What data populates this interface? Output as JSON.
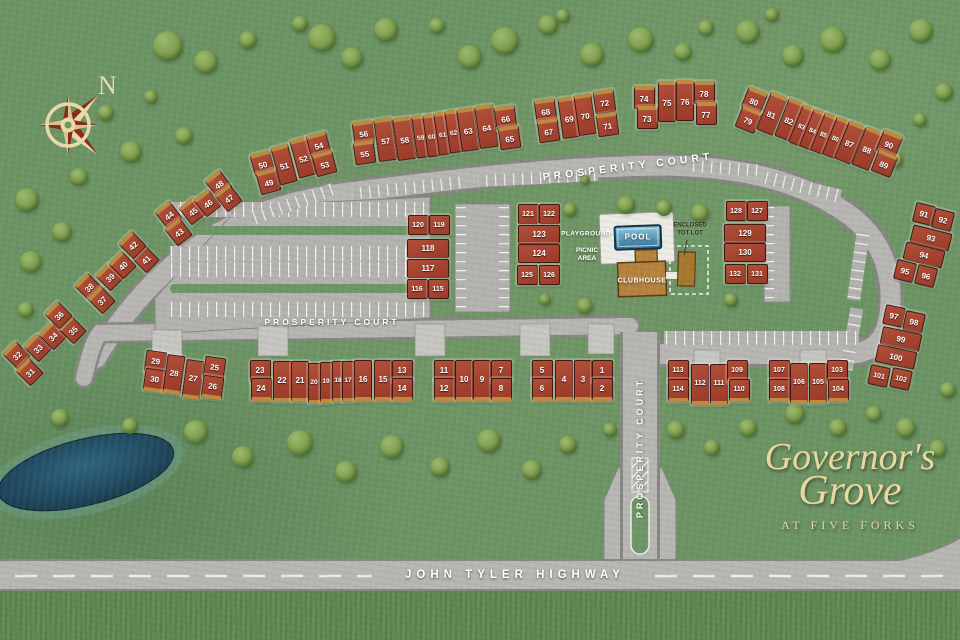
{
  "title": "Governor's Grove at Five Forks site plan",
  "compass": {
    "north": "N"
  },
  "streets": {
    "prosperity_top": "PROSPERITY COURT",
    "prosperity_mid": "PROSPERITY COURT",
    "prosperity_entrance": "PROSPERITY COURT",
    "highway": "JOHN TYLER HIGHWAY"
  },
  "amenities": {
    "playground": "PLAYGROUND",
    "picnic_line1": "PICNIC",
    "picnic_line2": "AREA",
    "pool": "POOL",
    "clubhouse": "CLUBHOUSE",
    "totlot_line1": "ENCLOSED",
    "totlot_line2": "TOT LOT"
  },
  "logo": {
    "line1": "Governor's",
    "line2": "Grove",
    "line3": "AT FIVE FORKS"
  },
  "colors": {
    "grass": "#6c9364",
    "road": "#b7b6b3",
    "building": "#a64733",
    "garage": "#bf8a3e",
    "pond": "#1d4a61",
    "pool_water": "#4a94b8",
    "clubhouse": "#b5813e",
    "logo_text": "#e9d6a0",
    "compass_cream": "#ead9a8",
    "compass_red": "#8c2b1b"
  },
  "buildings": {
    "clusters": [
      {
        "rot": 0,
        "garage": "bottom",
        "units": [
          [
            5,
            541,
            369,
            19,
            18
          ],
          [
            6,
            541,
            387,
            19,
            18
          ],
          [
            4,
            563,
            378,
            16,
            36
          ],
          [
            3,
            582,
            378,
            16,
            36
          ],
          [
            1,
            601,
            369,
            19,
            18
          ],
          [
            2,
            601,
            387,
            19,
            18
          ]
        ]
      },
      {
        "rot": 0,
        "garage": "bottom",
        "units": [
          [
            11,
            443,
            369,
            19,
            18
          ],
          [
            12,
            443,
            387,
            19,
            18
          ],
          [
            10,
            463,
            378,
            16,
            36
          ],
          [
            9,
            481,
            378,
            16,
            36
          ],
          [
            7,
            500,
            369,
            19,
            18
          ],
          [
            8,
            500,
            387,
            19,
            18
          ]
        ]
      },
      {
        "rot": 0,
        "garage": "bottom",
        "units": [
          [
            23,
            259,
            369,
            19,
            18
          ],
          [
            24,
            260,
            387,
            19,
            18
          ],
          [
            22,
            281,
            379,
            17,
            36
          ],
          [
            21,
            299,
            379,
            16,
            36
          ],
          [
            20,
            313,
            381,
            11,
            36
          ],
          [
            19,
            325,
            380,
            11,
            36
          ],
          [
            18,
            337,
            379,
            11,
            36
          ],
          [
            17,
            347,
            379,
            11,
            36
          ],
          [
            16,
            362,
            378,
            16,
            36
          ],
          [
            15,
            382,
            378,
            16,
            36
          ],
          [
            13,
            401,
            369,
            19,
            18
          ],
          [
            14,
            401,
            387,
            19,
            18
          ]
        ]
      },
      {
        "rot": 8,
        "garage": "bottom",
        "units": [
          [
            29,
            154,
            360,
            19,
            18
          ],
          [
            30,
            153,
            378,
            19,
            18
          ],
          [
            28,
            173,
            372,
            16,
            34
          ],
          [
            27,
            192,
            377,
            16,
            34
          ],
          [
            25,
            213,
            366,
            19,
            18
          ],
          [
            26,
            211,
            385,
            19,
            18
          ]
        ]
      },
      {
        "rot": 0,
        "garage": "bottom",
        "units": [
          [
            113,
            677,
            369,
            19,
            18
          ],
          [
            114,
            677,
            388,
            19,
            18
          ],
          [
            112,
            699,
            382,
            16,
            36
          ],
          [
            111,
            718,
            382,
            16,
            36
          ],
          [
            109,
            736,
            369,
            19,
            18
          ],
          [
            110,
            738,
            388,
            19,
            18
          ]
        ]
      },
      {
        "rot": 0,
        "garage": "bottom",
        "units": [
          [
            107,
            778,
            369,
            19,
            18
          ],
          [
            108,
            778,
            388,
            19,
            18
          ],
          [
            106,
            798,
            381,
            16,
            36
          ],
          [
            105,
            817,
            381,
            16,
            36
          ],
          [
            103,
            836,
            369,
            19,
            18
          ],
          [
            104,
            837,
            388,
            19,
            18
          ]
        ]
      },
      {
        "rot": -45,
        "garage": "top",
        "units": [
          [
            32,
            15,
            352,
            17,
            17
          ],
          [
            31,
            28,
            369,
            17,
            17
          ],
          [
            33,
            36,
            345,
            17,
            17
          ],
          [
            34,
            51,
            333,
            17,
            17
          ],
          [
            35,
            71,
            327,
            17,
            17
          ],
          [
            36,
            57,
            312,
            17,
            17
          ]
        ]
      },
      {
        "rot": -45,
        "garage": "top",
        "units": [
          [
            38,
            87,
            284,
            17,
            17
          ],
          [
            37,
            100,
            297,
            17,
            17
          ],
          [
            39,
            108,
            274,
            17,
            17
          ],
          [
            40,
            121,
            262,
            17,
            17
          ],
          [
            41,
            144,
            256,
            17,
            17
          ],
          [
            42,
            131,
            242,
            17,
            17
          ]
        ]
      },
      {
        "rot": -38,
        "garage": "top",
        "units": [
          [
            44,
            167,
            212,
            17,
            17
          ],
          [
            43,
            177,
            229,
            17,
            17
          ],
          [
            45,
            191,
            208,
            17,
            17
          ],
          [
            46,
            206,
            200,
            17,
            17
          ],
          [
            48,
            217,
            181,
            17,
            17
          ],
          [
            47,
            227,
            195,
            17,
            17
          ]
        ]
      },
      {
        "rot": -15,
        "garage": "top",
        "units": [
          [
            50,
            261,
            161,
            19,
            18
          ],
          [
            49,
            267,
            179,
            19,
            18
          ],
          [
            51,
            283,
            162,
            16,
            34
          ],
          [
            52,
            302,
            155,
            16,
            34
          ],
          [
            54,
            317,
            142,
            19,
            18
          ],
          [
            53,
            323,
            161,
            19,
            18
          ]
        ]
      },
      {
        "rot": -8,
        "garage": "top",
        "units": [
          [
            56,
            362,
            130,
            19,
            18
          ],
          [
            55,
            363,
            150,
            19,
            18
          ],
          [
            57,
            384,
            137,
            17,
            38
          ],
          [
            58,
            403,
            136,
            17,
            38
          ],
          [
            59,
            419,
            134,
            11,
            38
          ],
          [
            60,
            430,
            133,
            11,
            38
          ],
          [
            61,
            441,
            131,
            11,
            38
          ],
          [
            62,
            452,
            129,
            11,
            38
          ],
          [
            63,
            467,
            127,
            16,
            38
          ],
          [
            64,
            485,
            124,
            17,
            38
          ],
          [
            66,
            504,
            115,
            19,
            18
          ],
          [
            65,
            508,
            135,
            19,
            18
          ]
        ]
      },
      {
        "rot": -8,
        "garage": "top",
        "units": [
          [
            68,
            544,
            108,
            19,
            18
          ],
          [
            67,
            547,
            128,
            19,
            18
          ],
          [
            69,
            568,
            115,
            16,
            36
          ],
          [
            70,
            584,
            112,
            16,
            36
          ],
          [
            72,
            603,
            99,
            19,
            18
          ],
          [
            71,
            606,
            122,
            19,
            18
          ]
        ]
      },
      {
        "rot": 0,
        "garage": "top",
        "units": [
          [
            74,
            643,
            95,
            19,
            18
          ],
          [
            73,
            646,
            115,
            19,
            18
          ],
          [
            75,
            666,
            99,
            16,
            36
          ],
          [
            76,
            684,
            98,
            16,
            36
          ],
          [
            78,
            703,
            90,
            19,
            18
          ],
          [
            77,
            705,
            111,
            19,
            18
          ]
        ]
      },
      {
        "rot": 22,
        "garage": "top",
        "units": [
          [
            80,
            753,
            98,
            19,
            18
          ],
          [
            79,
            747,
            117,
            19,
            18
          ],
          [
            81,
            771,
            111,
            16,
            36
          ],
          [
            82,
            788,
            117,
            15,
            36
          ],
          [
            83,
            801,
            123,
            12,
            36
          ],
          [
            84,
            812,
            127,
            12,
            36
          ],
          [
            85,
            823,
            131,
            12,
            36
          ],
          [
            86,
            835,
            135,
            12,
            36
          ],
          [
            87,
            849,
            140,
            16,
            36
          ],
          [
            88,
            866,
            146,
            17,
            36
          ],
          [
            90,
            888,
            141,
            19,
            18
          ],
          [
            89,
            883,
            161,
            19,
            18
          ]
        ]
      },
      {
        "rot": 14,
        "units": [
          [
            91,
            923,
            213,
            18,
            18
          ],
          [
            92,
            942,
            219,
            18,
            18
          ],
          [
            93,
            930,
            237,
            38,
            16
          ],
          [
            94,
            923,
            254,
            38,
            16
          ],
          [
            95,
            904,
            270,
            18,
            18
          ],
          [
            96,
            925,
            275,
            18,
            18
          ]
        ]
      },
      {
        "rot": 12,
        "units": [
          [
            97,
            893,
            315,
            18,
            18
          ],
          [
            98,
            913,
            321,
            18,
            18
          ],
          [
            99,
            900,
            338,
            38,
            16
          ],
          [
            100,
            895,
            356,
            38,
            16
          ],
          [
            101,
            878,
            375,
            18,
            18
          ],
          [
            102,
            900,
            378,
            18,
            18
          ]
        ]
      },
      {
        "rot": 0,
        "units": [
          [
            120,
            417,
            224,
            19,
            18
          ],
          [
            119,
            438,
            224,
            19,
            18
          ],
          [
            118,
            427,
            247,
            40,
            17
          ],
          [
            117,
            427,
            267,
            40,
            17
          ],
          [
            116,
            416,
            288,
            19,
            18
          ],
          [
            115,
            437,
            288,
            19,
            18
          ]
        ]
      },
      {
        "rot": 0,
        "units": [
          [
            121,
            527,
            213,
            19,
            18
          ],
          [
            122,
            548,
            213,
            19,
            18
          ],
          [
            123,
            538,
            233,
            40,
            17
          ],
          [
            124,
            538,
            252,
            40,
            17
          ],
          [
            125,
            526,
            274,
            19,
            18
          ],
          [
            126,
            548,
            274,
            19,
            18
          ]
        ]
      },
      {
        "rot": 0,
        "units": [
          [
            128,
            735,
            210,
            19,
            18
          ],
          [
            127,
            756,
            210,
            19,
            18
          ],
          [
            129,
            744,
            232,
            40,
            17
          ],
          [
            130,
            744,
            251,
            40,
            17
          ],
          [
            132,
            734,
            273,
            19,
            18
          ],
          [
            131,
            756,
            273,
            19,
            18
          ]
        ]
      }
    ]
  },
  "trees": [
    [
      168,
      46,
      30
    ],
    [
      206,
      62,
      24
    ],
    [
      248,
      40,
      18
    ],
    [
      300,
      24,
      16
    ],
    [
      322,
      38,
      28
    ],
    [
      352,
      58,
      22
    ],
    [
      386,
      30,
      24
    ],
    [
      437,
      26,
      16
    ],
    [
      470,
      57,
      24
    ],
    [
      505,
      41,
      28
    ],
    [
      548,
      25,
      20
    ],
    [
      563,
      16,
      14
    ],
    [
      592,
      55,
      24
    ],
    [
      641,
      40,
      26
    ],
    [
      683,
      52,
      18
    ],
    [
      706,
      28,
      16
    ],
    [
      748,
      32,
      24
    ],
    [
      772,
      15,
      14
    ],
    [
      793,
      56,
      22
    ],
    [
      833,
      40,
      26
    ],
    [
      880,
      60,
      22
    ],
    [
      921,
      31,
      24
    ],
    [
      944,
      92,
      18
    ],
    [
      920,
      120,
      14
    ],
    [
      27,
      200,
      24
    ],
    [
      62,
      232,
      20
    ],
    [
      31,
      262,
      22
    ],
    [
      79,
      177,
      18
    ],
    [
      26,
      310,
      16
    ],
    [
      131,
      152,
      22
    ],
    [
      184,
      136,
      18
    ],
    [
      106,
      113,
      16
    ],
    [
      151,
      97,
      14
    ],
    [
      60,
      418,
      18
    ],
    [
      130,
      426,
      16
    ],
    [
      196,
      432,
      24
    ],
    [
      243,
      457,
      22
    ],
    [
      300,
      443,
      26
    ],
    [
      346,
      472,
      22
    ],
    [
      392,
      447,
      24
    ],
    [
      440,
      467,
      20
    ],
    [
      489,
      441,
      24
    ],
    [
      532,
      470,
      20
    ],
    [
      568,
      445,
      18
    ],
    [
      610,
      430,
      14
    ],
    [
      676,
      430,
      18
    ],
    [
      712,
      448,
      16
    ],
    [
      748,
      428,
      18
    ],
    [
      795,
      414,
      20
    ],
    [
      838,
      428,
      18
    ],
    [
      874,
      414,
      16
    ],
    [
      906,
      428,
      20
    ],
    [
      938,
      449,
      18
    ],
    [
      948,
      390,
      16
    ],
    [
      585,
      306,
      16
    ],
    [
      570,
      210,
      14
    ],
    [
      626,
      205,
      18
    ],
    [
      664,
      208,
      16
    ],
    [
      700,
      213,
      18
    ],
    [
      731,
      300,
      14
    ],
    [
      585,
      180,
      10
    ],
    [
      545,
      300,
      12
    ],
    [
      895,
      160,
      16
    ],
    [
      935,
      255,
      14
    ]
  ]
}
